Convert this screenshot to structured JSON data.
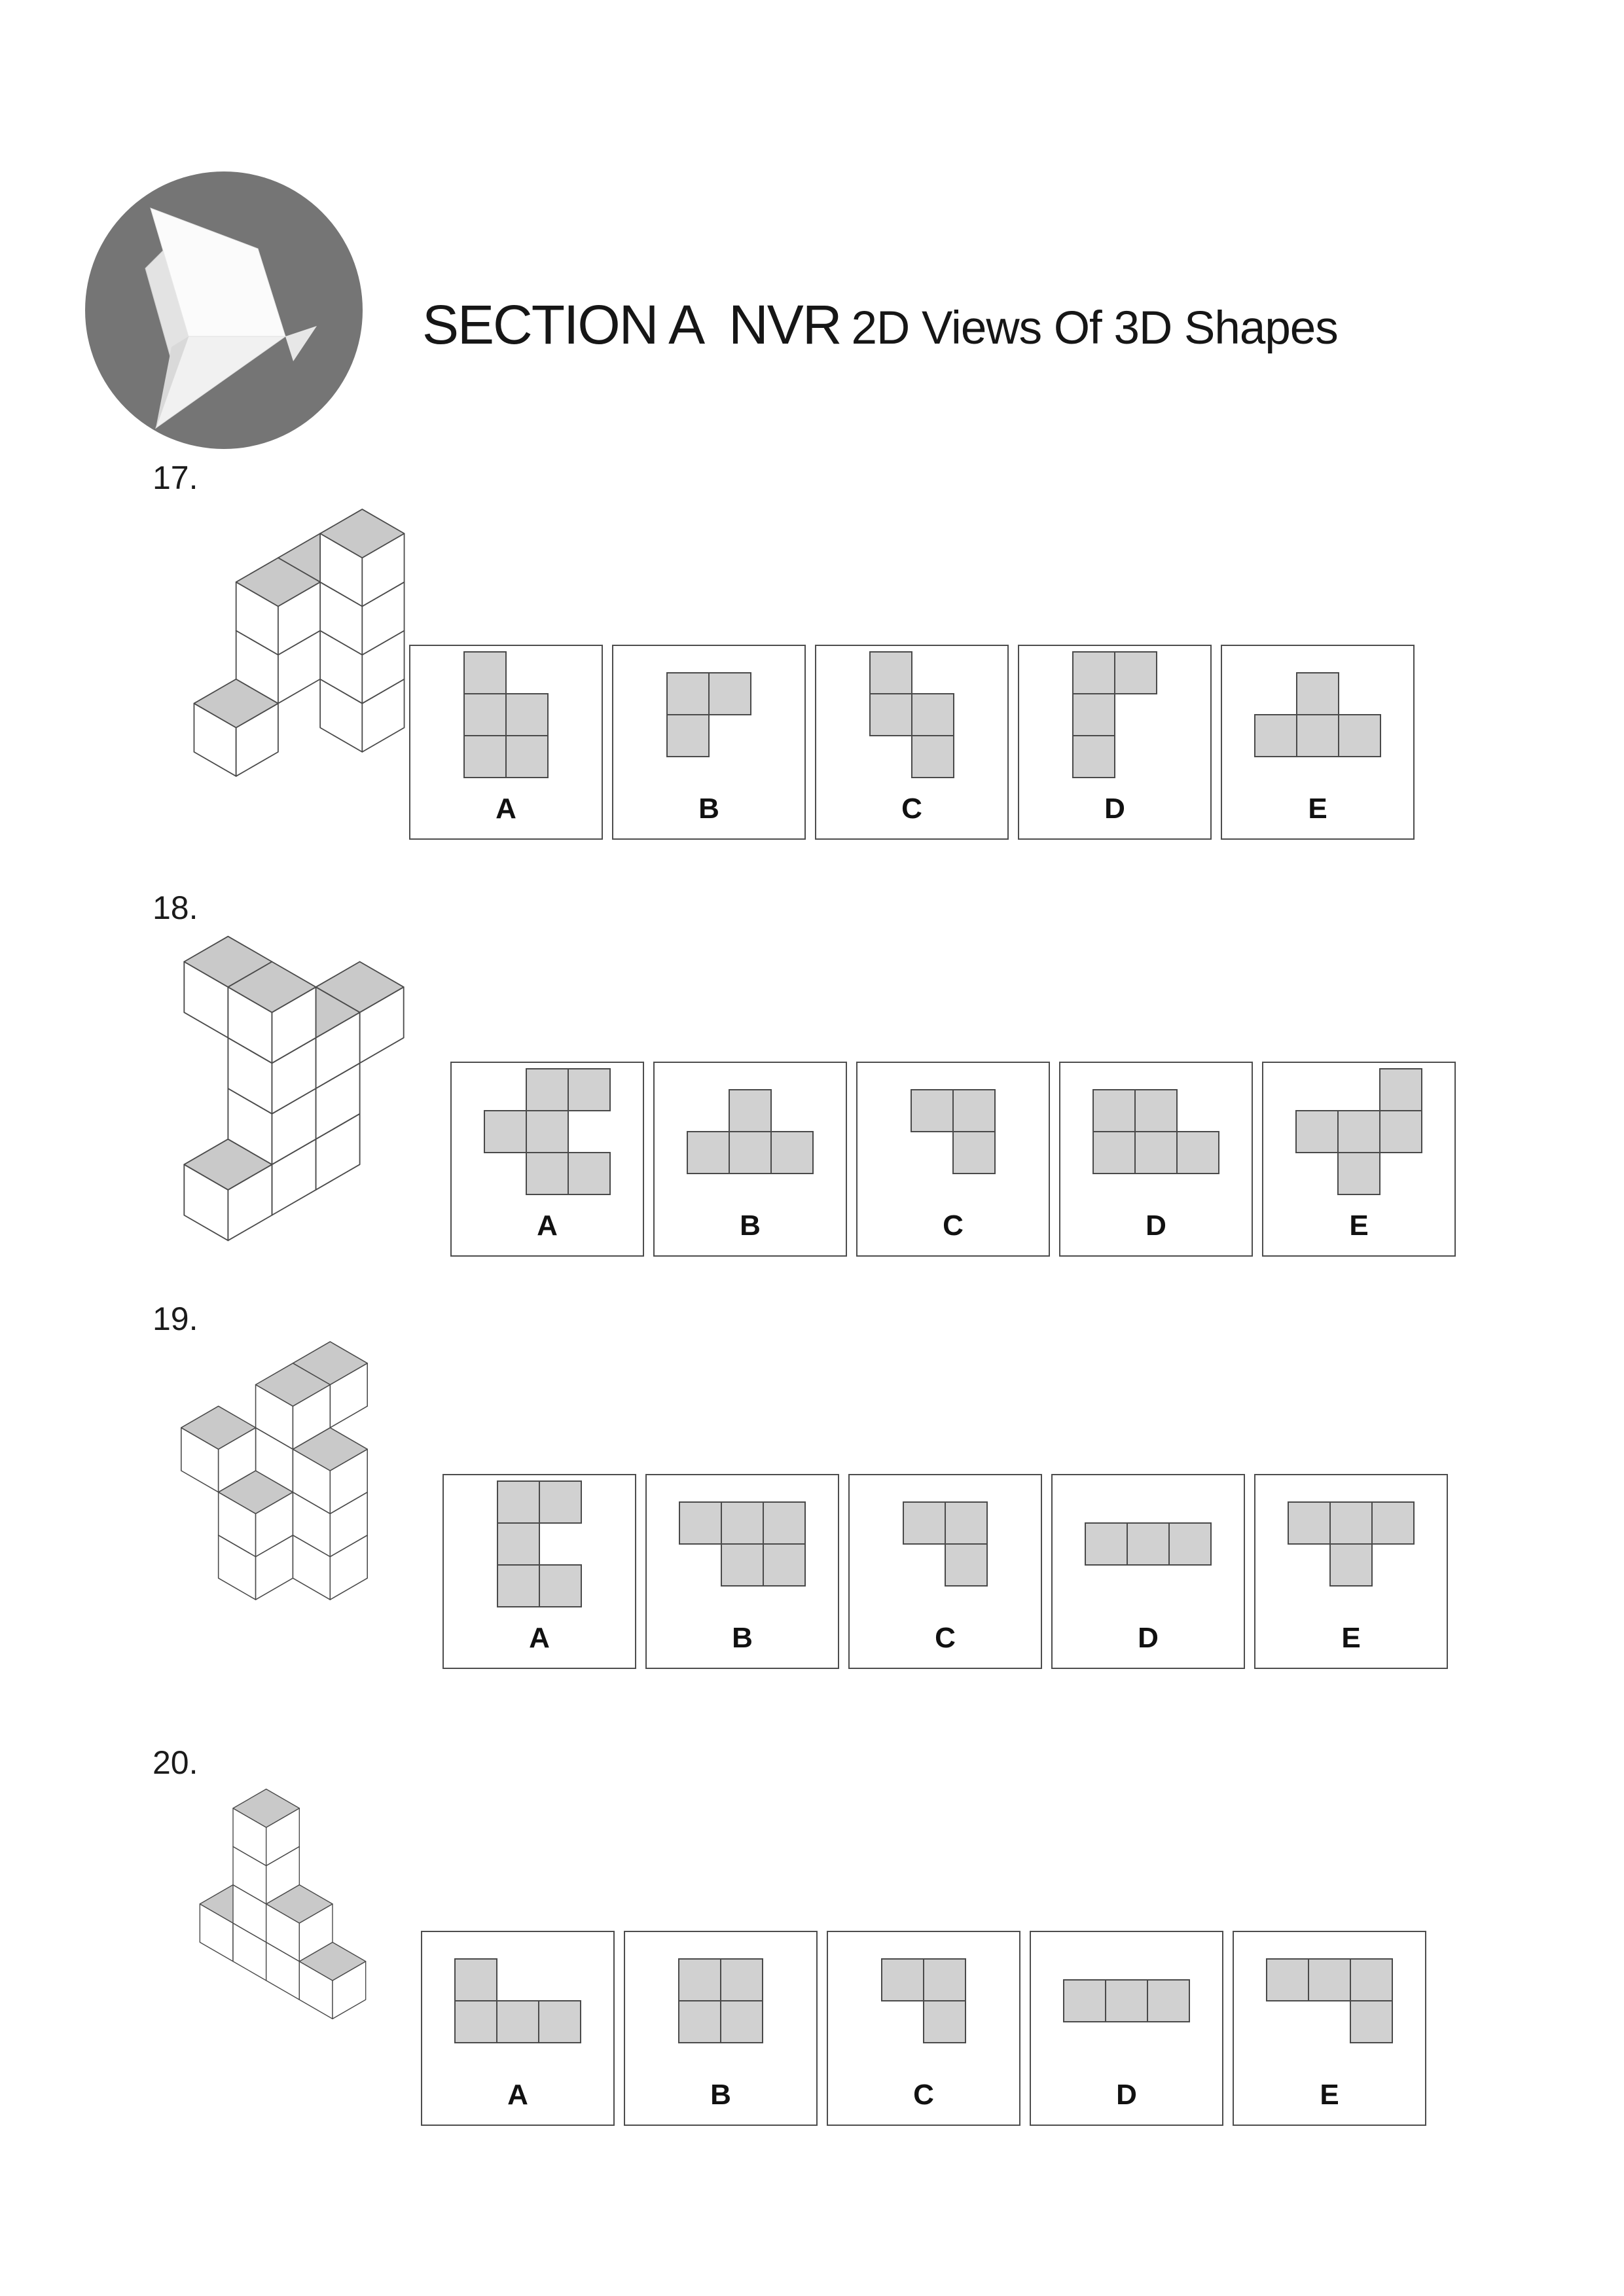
{
  "header": {
    "title_main": "SECTION A  NVR",
    "title_sub": "2D Views Of 3D Shapes",
    "logo": {
      "icon": "origami-bird-icon"
    }
  },
  "colors": {
    "logo_circle": "#757575",
    "text": "#161616",
    "cube_top": "#c9c9c9",
    "cube_side": "#ffffff",
    "edge": "#4b4b4b",
    "square_fill": "#d1d1d1",
    "square_border": "#4a4a4a",
    "box_border": "#4d4d4d"
  },
  "questions": [
    {
      "id": "q17",
      "number": "17.",
      "figure_cubes": [
        [
          1,
          0,
          0
        ],
        [
          1,
          0,
          1
        ],
        [
          1,
          0,
          2
        ],
        [
          1,
          0,
          3
        ],
        [
          0,
          0,
          2
        ],
        [
          0,
          1,
          1
        ],
        [
          0,
          1,
          2
        ],
        [
          0,
          2,
          0
        ]
      ],
      "options": [
        {
          "label": "A",
          "cells": [
            [
              0,
              0
            ],
            [
              0,
              1
            ],
            [
              1,
              1
            ],
            [
              0,
              2
            ],
            [
              1,
              2
            ]
          ]
        },
        {
          "label": "B",
          "cells": [
            [
              0,
              0
            ],
            [
              1,
              0
            ],
            [
              0,
              1
            ]
          ]
        },
        {
          "label": "C",
          "cells": [
            [
              0,
              0
            ],
            [
              0,
              1
            ],
            [
              1,
              1
            ],
            [
              1,
              2
            ]
          ]
        },
        {
          "label": "D",
          "cells": [
            [
              0,
              0
            ],
            [
              1,
              0
            ],
            [
              0,
              1
            ],
            [
              0,
              2
            ]
          ]
        },
        {
          "label": "E",
          "cells": [
            [
              1,
              0
            ],
            [
              0,
              1
            ],
            [
              1,
              1
            ],
            [
              2,
              1
            ]
          ]
        }
      ]
    },
    {
      "id": "q18",
      "number": "18.",
      "figure_cubes": [
        [
          1,
          2,
          0
        ],
        [
          1,
          2,
          1
        ],
        [
          1,
          2,
          2
        ],
        [
          1,
          2,
          3
        ],
        [
          0,
          2,
          3
        ],
        [
          1,
          1,
          2
        ],
        [
          1,
          0,
          2
        ],
        [
          1,
          1,
          1
        ],
        [
          1,
          1,
          0
        ],
        [
          1,
          3,
          0
        ]
      ],
      "options": [
        {
          "label": "A",
          "cells": [
            [
              1,
              0
            ],
            [
              2,
              0
            ],
            [
              0,
              1
            ],
            [
              1,
              1
            ],
            [
              1,
              2
            ],
            [
              2,
              2
            ]
          ]
        },
        {
          "label": "B",
          "cells": [
            [
              1,
              0
            ],
            [
              0,
              1
            ],
            [
              1,
              1
            ],
            [
              2,
              1
            ]
          ]
        },
        {
          "label": "C",
          "cells": [
            [
              0,
              0
            ],
            [
              1,
              0
            ],
            [
              1,
              1
            ]
          ]
        },
        {
          "label": "D",
          "cells": [
            [
              0,
              0
            ],
            [
              1,
              0
            ],
            [
              0,
              1
            ],
            [
              1,
              1
            ],
            [
              2,
              1
            ]
          ]
        },
        {
          "label": "E",
          "cells": [
            [
              2,
              0
            ],
            [
              0,
              1
            ],
            [
              1,
              1
            ],
            [
              2,
              1
            ],
            [
              1,
              2
            ]
          ]
        }
      ]
    },
    {
      "id": "q19",
      "number": "19.",
      "figure_cubes": [
        [
          1,
          0,
          3
        ],
        [
          1,
          1,
          3
        ],
        [
          1,
          1,
          2
        ],
        [
          1,
          1,
          1
        ],
        [
          1,
          2,
          1
        ],
        [
          1,
          2,
          0
        ],
        [
          0,
          2,
          2
        ],
        [
          2,
          1,
          2
        ],
        [
          2,
          1,
          1
        ],
        [
          2,
          1,
          0
        ]
      ],
      "options": [
        {
          "label": "A",
          "cells": [
            [
              0,
              0
            ],
            [
              1,
              0
            ],
            [
              0,
              1
            ],
            [
              0,
              2
            ],
            [
              1,
              2
            ]
          ]
        },
        {
          "label": "B",
          "cells": [
            [
              0,
              0
            ],
            [
              1,
              0
            ],
            [
              2,
              0
            ],
            [
              1,
              1
            ],
            [
              2,
              1
            ]
          ]
        },
        {
          "label": "C",
          "cells": [
            [
              0,
              0
            ],
            [
              1,
              0
            ],
            [
              1,
              1
            ]
          ]
        },
        {
          "label": "D",
          "cells": [
            [
              0,
              0
            ],
            [
              1,
              0
            ],
            [
              2,
              0
            ]
          ]
        },
        {
          "label": "E",
          "cells": [
            [
              0,
              0
            ],
            [
              1,
              0
            ],
            [
              2,
              0
            ],
            [
              1,
              1
            ]
          ]
        }
      ]
    },
    {
      "id": "q20",
      "number": "20.",
      "figure_cubes": [
        [
          1,
          1,
          0
        ],
        [
          1,
          1,
          1
        ],
        [
          1,
          1,
          2
        ],
        [
          1,
          1,
          3
        ],
        [
          0,
          1,
          0
        ],
        [
          2,
          1,
          1
        ],
        [
          2,
          1,
          0
        ],
        [
          3,
          1,
          0
        ]
      ],
      "options": [
        {
          "label": "A",
          "cells": [
            [
              0,
              0
            ],
            [
              0,
              1
            ],
            [
              1,
              1
            ],
            [
              2,
              1
            ]
          ]
        },
        {
          "label": "B",
          "cells": [
            [
              0,
              0
            ],
            [
              1,
              0
            ],
            [
              0,
              1
            ],
            [
              1,
              1
            ]
          ]
        },
        {
          "label": "C",
          "cells": [
            [
              0,
              0
            ],
            [
              1,
              0
            ],
            [
              1,
              1
            ]
          ]
        },
        {
          "label": "D",
          "cells": [
            [
              0,
              0
            ],
            [
              1,
              0
            ],
            [
              2,
              0
            ]
          ]
        },
        {
          "label": "E",
          "cells": [
            [
              0,
              0
            ],
            [
              1,
              0
            ],
            [
              2,
              0
            ],
            [
              2,
              1
            ]
          ]
        }
      ]
    }
  ]
}
